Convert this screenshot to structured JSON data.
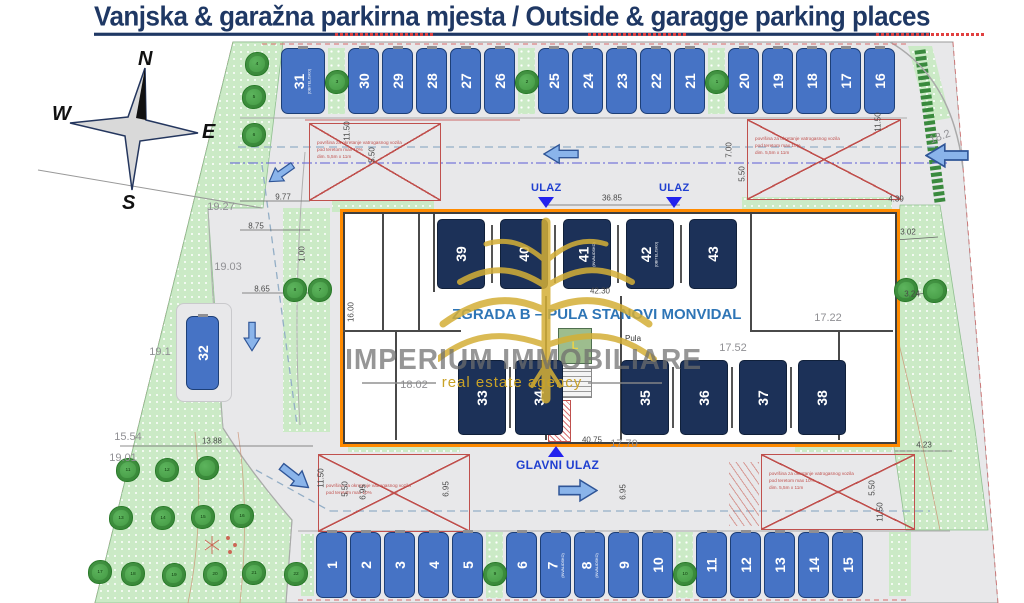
{
  "title": "Vanjska & garažna parkirna mjesta / Outside & garagge parking places",
  "compass": {
    "n": "N",
    "w": "W",
    "e": "E",
    "s": "S"
  },
  "building_label": "ZGRADA B – PULA STANOVI MONVIDAL",
  "street_label": "Pula",
  "lift_label": "L",
  "watermark": {
    "line1": "IMPERIUM IMMOBILIARE",
    "line2": "real estate agency"
  },
  "entrances": {
    "ulaz": "ULAZ",
    "glavni": "GLAVNI ULAZ"
  },
  "fire_area": {
    "l1": "površina za okretanje vatrogasnog vozila",
    "l2": "pod teretom max 10%",
    "l3": "dim. 5,5m x 11m"
  },
  "parking": {
    "top_row": [
      {
        "num": "31",
        "tag": "(OBITELJSKO)",
        "wide": true
      },
      {
        "gap": true,
        "tree": "3"
      },
      {
        "num": "30"
      },
      {
        "num": "29"
      },
      {
        "num": "28"
      },
      {
        "num": "27"
      },
      {
        "num": "26"
      },
      {
        "gap": true,
        "tree": "2"
      },
      {
        "num": "25"
      },
      {
        "num": "24"
      },
      {
        "num": "23"
      },
      {
        "num": "22"
      },
      {
        "num": "21"
      },
      {
        "gap": true,
        "tree": "1"
      },
      {
        "num": "20"
      },
      {
        "num": "19"
      },
      {
        "num": "18"
      },
      {
        "num": "17"
      },
      {
        "num": "16"
      }
    ],
    "bottom_row": [
      {
        "num": "1"
      },
      {
        "num": "2"
      },
      {
        "num": "3"
      },
      {
        "num": "4"
      },
      {
        "num": "5"
      },
      {
        "gap": true,
        "tree": "9"
      },
      {
        "num": "6"
      },
      {
        "num": "7",
        "tag": "(INVALIDSKO)"
      },
      {
        "num": "8",
        "tag": "(INVALIDSKO)"
      },
      {
        "num": "9"
      },
      {
        "num": "10"
      },
      {
        "gap": true,
        "tree": "10"
      },
      {
        "num": "11"
      },
      {
        "num": "12"
      },
      {
        "num": "13"
      },
      {
        "num": "14"
      },
      {
        "num": "15"
      }
    ],
    "garage_top": [
      {
        "num": "39"
      },
      {
        "num": "40"
      },
      {
        "num": "41",
        "tag": "(INVALIDSKO)"
      },
      {
        "num": "42",
        "tag": "(OBITELJSKO)"
      },
      {
        "num": "43"
      }
    ],
    "garage_bottom_left": [
      {
        "num": "33"
      },
      {
        "num": "34"
      }
    ],
    "garage_bottom_right": [
      {
        "num": "35"
      },
      {
        "num": "36"
      },
      {
        "num": "37"
      },
      {
        "num": "38"
      }
    ],
    "outside_left": {
      "num": "32"
    }
  },
  "trees": [
    {
      "x": 257,
      "y": 64,
      "n": "4"
    },
    {
      "x": 254,
      "y": 97,
      "n": "5"
    },
    {
      "x": 254,
      "y": 135,
      "n": "6"
    },
    {
      "x": 295,
      "y": 290,
      "n": "8"
    },
    {
      "x": 320,
      "y": 290,
      "n": "7"
    },
    {
      "x": 906,
      "y": 290,
      "n": ""
    },
    {
      "x": 935,
      "y": 291,
      "n": ""
    },
    {
      "x": 128,
      "y": 470,
      "n": "11"
    },
    {
      "x": 167,
      "y": 470,
      "n": "12"
    },
    {
      "x": 207,
      "y": 468,
      "n": ""
    },
    {
      "x": 121,
      "y": 518,
      "n": "13"
    },
    {
      "x": 163,
      "y": 518,
      "n": "14"
    },
    {
      "x": 203,
      "y": 517,
      "n": "15"
    },
    {
      "x": 242,
      "y": 516,
      "n": "16"
    },
    {
      "x": 100,
      "y": 572,
      "n": "17"
    },
    {
      "x": 133,
      "y": 574,
      "n": "18"
    },
    {
      "x": 174,
      "y": 575,
      "n": "19"
    },
    {
      "x": 215,
      "y": 574,
      "n": "20"
    },
    {
      "x": 254,
      "y": 573,
      "n": "21"
    },
    {
      "x": 296,
      "y": 574,
      "n": "22"
    }
  ],
  "dims": [
    {
      "t": "9.77",
      "x": 283,
      "y": 197
    },
    {
      "t": "19.27",
      "x": 221,
      "y": 207,
      "big": 1
    },
    {
      "t": "8.75",
      "x": 256,
      "y": 226
    },
    {
      "t": "19.03",
      "x": 228,
      "y": 267,
      "big": 1
    },
    {
      "t": "8.65",
      "x": 262,
      "y": 289
    },
    {
      "t": "1.00",
      "x": 302,
      "y": 254,
      "v": 1
    },
    {
      "t": "16.00",
      "x": 351,
      "y": 312,
      "v": 1
    },
    {
      "t": "19.1",
      "x": 160,
      "y": 352,
      "big": 1
    },
    {
      "t": "18.02",
      "x": 414,
      "y": 385,
      "big": 1
    },
    {
      "t": "36.85",
      "x": 612,
      "y": 198
    },
    {
      "t": "42.30",
      "x": 600,
      "y": 291
    },
    {
      "t": "40.75",
      "x": 592,
      "y": 440
    },
    {
      "t": "17.70",
      "x": 624,
      "y": 444,
      "big": 1
    },
    {
      "t": "17.52",
      "x": 733,
      "y": 348,
      "big": 1
    },
    {
      "t": "17.22",
      "x": 828,
      "y": 318,
      "big": 1
    },
    {
      "t": "11.50",
      "x": 347,
      "y": 131,
      "v": 1
    },
    {
      "t": "5.50",
      "x": 372,
      "y": 155,
      "v": 1
    },
    {
      "t": "11.50",
      "x": 878,
      "y": 122,
      "v": 1
    },
    {
      "t": "7.00",
      "x": 729,
      "y": 150,
      "v": 1
    },
    {
      "t": "5.50",
      "x": 742,
      "y": 174,
      "v": 1
    },
    {
      "t": "18.2",
      "x": 940,
      "y": 137,
      "big": 1,
      "r": -20
    },
    {
      "t": "4.39",
      "x": 896,
      "y": 199
    },
    {
      "t": "3.02",
      "x": 908,
      "y": 232
    },
    {
      "t": "3.24",
      "x": 912,
      "y": 294
    },
    {
      "t": "4.23",
      "x": 924,
      "y": 445
    },
    {
      "t": "5.50",
      "x": 872,
      "y": 488,
      "v": 1
    },
    {
      "t": "11.50",
      "x": 880,
      "y": 512,
      "v": 1
    },
    {
      "t": "15.54",
      "x": 128,
      "y": 437,
      "big": 1
    },
    {
      "t": "13.88",
      "x": 212,
      "y": 441
    },
    {
      "t": "19.01",
      "x": 123,
      "y": 458,
      "big": 1
    },
    {
      "t": "11.50",
      "x": 321,
      "y": 478,
      "v": 1
    },
    {
      "t": "5.50",
      "x": 345,
      "y": 489,
      "v": 1
    },
    {
      "t": "6.95",
      "x": 363,
      "y": 492,
      "v": 1
    },
    {
      "t": "6.95",
      "x": 446,
      "y": 489,
      "v": 1
    },
    {
      "t": "6.95",
      "x": 623,
      "y": 492,
      "v": 1
    }
  ],
  "arrows": [
    {
      "x": 281,
      "y": 173,
      "r": 145,
      "s": 30
    },
    {
      "x": 561,
      "y": 154,
      "r": 180,
      "s": 36
    },
    {
      "x": 947,
      "y": 155,
      "r": 180,
      "s": 44
    },
    {
      "x": 252,
      "y": 336,
      "r": 90,
      "s": 30
    },
    {
      "x": 295,
      "y": 477,
      "r": 38,
      "s": 36
    },
    {
      "x": 578,
      "y": 490,
      "r": 0,
      "s": 40
    }
  ]
}
